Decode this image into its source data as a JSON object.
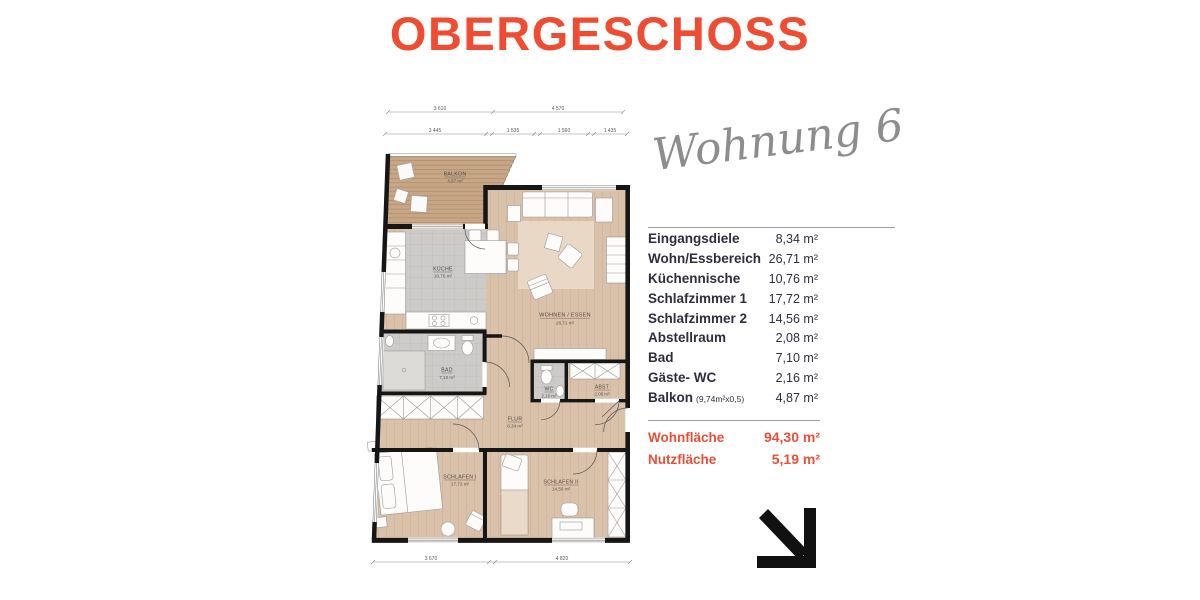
{
  "title": "OBERGESCHOSS",
  "handwritten_label": "Wohnung 6",
  "room_table": {
    "rows": [
      {
        "label": "Eingangsdiele",
        "note": "",
        "area": "8,34 m²"
      },
      {
        "label": "Wohn/Essbereich",
        "note": "",
        "area": "26,71 m²"
      },
      {
        "label": "Küchennische",
        "note": "",
        "area": "10,76 m²"
      },
      {
        "label": "Schlafzimmer 1",
        "note": "",
        "area": "17,72 m²"
      },
      {
        "label": "Schlafzimmer 2",
        "note": "",
        "area": "14,56 m²"
      },
      {
        "label": "Abstellraum",
        "note": "",
        "area": "2,08 m²"
      },
      {
        "label": "Bad",
        "note": "",
        "area": "7,10 m²"
      },
      {
        "label": "Gäste- WC",
        "note": "",
        "area": "2,16 m²"
      },
      {
        "label": "Balkon",
        "note": "(9,74m²x0,5)",
        "area": "4,87 m²"
      }
    ],
    "totals": [
      {
        "label": "Wohnfläche",
        "area": "94,30 m²"
      },
      {
        "label": "Nutzfläche",
        "area": "5,19 m²"
      }
    ]
  },
  "floor_plan": {
    "dims_top_row1": [
      "3 610",
      "4 570"
    ],
    "dims_top_row2": [
      "3 445",
      "1 535",
      "1 560",
      "1 435"
    ],
    "dims_bottom": [
      "3 670",
      "4 820"
    ],
    "rooms": {
      "balkon": {
        "name": "BALKON",
        "area": "4,87 m²"
      },
      "kueche": {
        "name": "KÜCHE",
        "area": "10,76 m²"
      },
      "wohnen": {
        "name": "WOHNEN / ESSEN",
        "area": "26,71 m²"
      },
      "bad": {
        "name": "BAD",
        "area": "7,10 m²"
      },
      "wc": {
        "name": "WC",
        "area": "2,16 m²"
      },
      "abst": {
        "name": "ABST",
        "area": "2,08 m²"
      },
      "flur": {
        "name": "FLUR",
        "area": "8,34 m²"
      },
      "schlafen1": {
        "name": "SCHLAFEN I",
        "area": "17,72 m²"
      },
      "schlafen2": {
        "name": "SCHLAFEN II",
        "area": "14,56 m²"
      }
    }
  },
  "colors": {
    "accent_orange": "#EF4C32",
    "totals_orange": "#E84F36",
    "table_text": "#2E2E3E",
    "script_gray": "#8D8D8D",
    "wall_black": "#161616",
    "wood_floor": "#DAC1A9",
    "deck_wood": "#C7A685",
    "tile_gray": "#CCCBC9"
  },
  "icons": {
    "corner_arrow": "arrow-down-right-corner"
  }
}
